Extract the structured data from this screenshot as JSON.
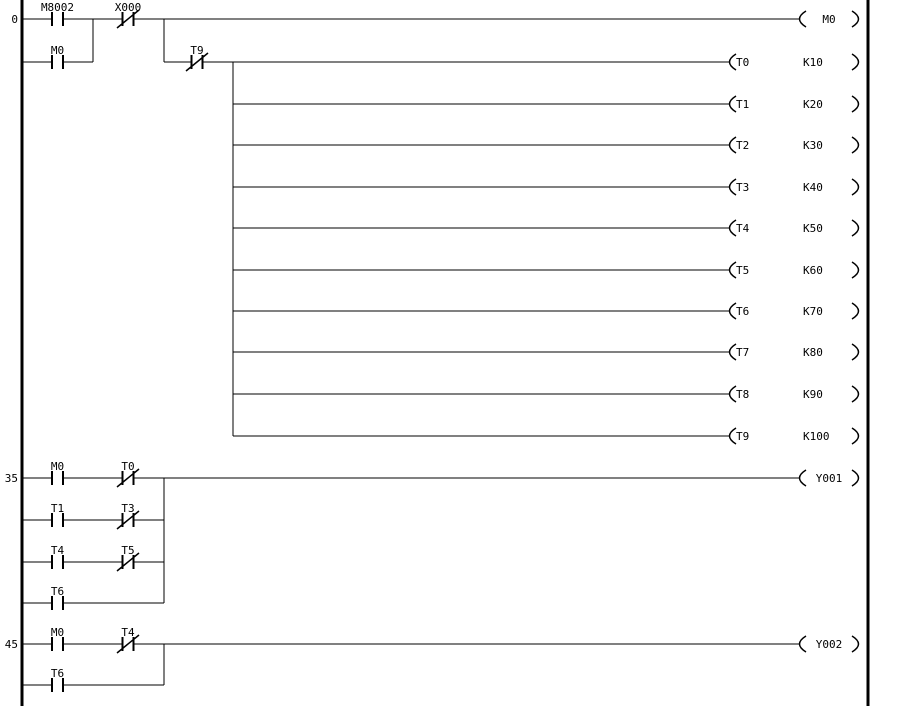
{
  "app": {
    "view": "ladder-logic-editor",
    "background_color": "#ffffff",
    "line_color": "#000000"
  },
  "ladder": {
    "rungs": [
      {
        "number": "0",
        "contacts": [
          {
            "label": "M8002",
            "type": "normally-open"
          },
          {
            "label": "X000",
            "type": "normally-closed"
          },
          {
            "label": "M0",
            "type": "normally-open"
          },
          {
            "label": "T9",
            "type": "normally-closed"
          }
        ],
        "coil": {
          "label": "M0"
        }
      },
      {
        "number": "35",
        "contacts": [
          {
            "label": "M0",
            "type": "normally-open"
          },
          {
            "label": "T0",
            "type": "normally-closed"
          },
          {
            "label": "T1",
            "type": "normally-open"
          },
          {
            "label": "T3",
            "type": "normally-closed"
          },
          {
            "label": "T4",
            "type": "normally-open"
          },
          {
            "label": "T5",
            "type": "normally-closed"
          },
          {
            "label": "T6",
            "type": "normally-open"
          }
        ],
        "coil": {
          "label": "Y001"
        }
      },
      {
        "number": "45",
        "contacts": [
          {
            "label": "M0",
            "type": "normally-open"
          },
          {
            "label": "T4",
            "type": "normally-closed"
          },
          {
            "label": "T6",
            "type": "normally-open"
          }
        ],
        "coil": {
          "label": "Y002"
        }
      }
    ],
    "timers": [
      {
        "name": "T0",
        "preset": "K10"
      },
      {
        "name": "T1",
        "preset": "K20"
      },
      {
        "name": "T2",
        "preset": "K30"
      },
      {
        "name": "T3",
        "preset": "K40"
      },
      {
        "name": "T4",
        "preset": "K50"
      },
      {
        "name": "T5",
        "preset": "K60"
      },
      {
        "name": "T6",
        "preset": "K70"
      },
      {
        "name": "T7",
        "preset": "K80"
      },
      {
        "name": "T8",
        "preset": "K90"
      },
      {
        "name": "T9",
        "preset": "K100"
      }
    ]
  }
}
